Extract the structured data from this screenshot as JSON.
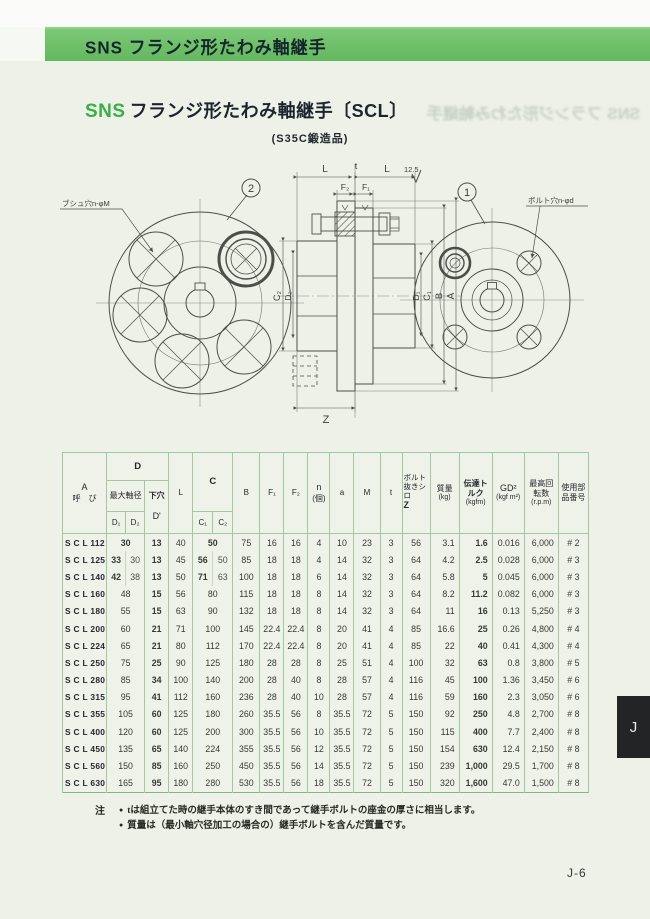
{
  "page": {
    "banner_title": "SNS フランジ形たわみ軸継手",
    "title_brand": "SNS",
    "title_text": "フランジ形たわみ軸継手〔SCL〕",
    "subtitle": "(S35C鍛造品)",
    "ghost_text": "SNS フランジ形たわみ軸継手",
    "side_tab": "J",
    "page_number": "J-6"
  },
  "drawing": {
    "balloon_left": "2",
    "balloon_right": "1",
    "callout_left": "ブシュ穴n-φM",
    "callout_right": "ボルト穴n-φd",
    "finish_mark": "12.5",
    "dims": {
      "l": "L",
      "t": "t",
      "f1": "F₁",
      "f2": "F₂",
      "c1": "C₁",
      "c2": "C₂",
      "d1": "D₁",
      "d2": "D₂",
      "b": "B",
      "a": "A",
      "z": "Z"
    }
  },
  "table": {
    "header": {
      "a_label": "A",
      "call_label": "呼　び",
      "d_group": "D",
      "max_shaft": "最大軸径",
      "pilot": "下穴",
      "pilot_sub": "D'",
      "d1": "D₁",
      "d2": "D₂",
      "l": "L",
      "c_group": "C",
      "c1": "C₁",
      "c2": "C₂",
      "b": "B",
      "f1": "F₁",
      "f2": "F₂",
      "n": "n",
      "n_unit": "(個)",
      "a": "a",
      "m": "M",
      "t": "t",
      "z_label": "ボルト抜きシロ",
      "z_sub": "Z",
      "mass": "質量",
      "mass_unit": "(kg)",
      "torque": "伝達トルク",
      "torque_unit": "(kgfm)",
      "gd2": "GD²",
      "gd2_unit": "(kgf m²)",
      "rpm": "最高回転数",
      "rpm_unit": "(r.p.m)",
      "part": "使用部品番号"
    },
    "rows": [
      {
        "name": "S C L 112",
        "d": [
          "30"
        ],
        "pilot": "13",
        "l": "40",
        "c": [
          "50"
        ],
        "b": "75",
        "f1": "16",
        "f2": "16",
        "n": "4",
        "a": "10",
        "m": "23",
        "t": "3",
        "z": "56",
        "mass": "3.1",
        "torque": "1.6",
        "gd2": "0.016",
        "rpm": "6,000",
        "part": "# 2"
      },
      {
        "name": "S C L 125",
        "d": [
          "33",
          "30"
        ],
        "pilot": "13",
        "l": "45",
        "c": [
          "56",
          "50"
        ],
        "b": "85",
        "f1": "18",
        "f2": "18",
        "n": "4",
        "a": "14",
        "m": "32",
        "t": "3",
        "z": "64",
        "mass": "4.2",
        "torque": "2.5",
        "gd2": "0.028",
        "rpm": "6,000",
        "part": "# 3"
      },
      {
        "name": "S C L 140",
        "d": [
          "42",
          "38"
        ],
        "pilot": "13",
        "l": "50",
        "c": [
          "71",
          "63"
        ],
        "b": "100",
        "f1": "18",
        "f2": "18",
        "n": "6",
        "a": "14",
        "m": "32",
        "t": "3",
        "z": "64",
        "mass": "5.8",
        "torque": "5",
        "gd2": "0.045",
        "rpm": "6,000",
        "part": "# 3"
      },
      {
        "name": "S C L 160",
        "d": [
          "48"
        ],
        "pilot": "15",
        "l": "56",
        "c": [
          "80"
        ],
        "b": "115",
        "f1": "18",
        "f2": "18",
        "n": "8",
        "a": "14",
        "m": "32",
        "t": "3",
        "z": "64",
        "mass": "8.2",
        "torque": "11.2",
        "gd2": "0.082",
        "rpm": "6,000",
        "part": "# 3"
      },
      {
        "name": "S C L 180",
        "d": [
          "55"
        ],
        "pilot": "15",
        "l": "63",
        "c": [
          "90"
        ],
        "b": "132",
        "f1": "18",
        "f2": "18",
        "n": "8",
        "a": "14",
        "m": "32",
        "t": "3",
        "z": "64",
        "mass": "11",
        "torque": "16",
        "gd2": "0.13",
        "rpm": "5,250",
        "part": "# 3"
      },
      {
        "name": "S C L 200",
        "d": [
          "60"
        ],
        "pilot": "21",
        "l": "71",
        "c": [
          "100"
        ],
        "b": "145",
        "f1": "22.4",
        "f2": "22.4",
        "n": "8",
        "a": "20",
        "m": "41",
        "t": "4",
        "z": "85",
        "mass": "16.6",
        "torque": "25",
        "gd2": "0.26",
        "rpm": "4,800",
        "part": "# 4"
      },
      {
        "name": "S C L 224",
        "d": [
          "65"
        ],
        "pilot": "21",
        "l": "80",
        "c": [
          "112"
        ],
        "b": "170",
        "f1": "22.4",
        "f2": "22.4",
        "n": "8",
        "a": "20",
        "m": "41",
        "t": "4",
        "z": "85",
        "mass": "22",
        "torque": "40",
        "gd2": "0.41",
        "rpm": "4,300",
        "part": "# 4"
      },
      {
        "name": "S C L 250",
        "d": [
          "75"
        ],
        "pilot": "25",
        "l": "90",
        "c": [
          "125"
        ],
        "b": "180",
        "f1": "28",
        "f2": "28",
        "n": "8",
        "a": "25",
        "m": "51",
        "t": "4",
        "z": "100",
        "mass": "32",
        "torque": "63",
        "gd2": "0.8",
        "rpm": "3,800",
        "part": "# 5"
      },
      {
        "name": "S C L 280",
        "d": [
          "85"
        ],
        "pilot": "34",
        "l": "100",
        "c": [
          "140"
        ],
        "b": "200",
        "f1": "28",
        "f2": "40",
        "n": "8",
        "a": "28",
        "m": "57",
        "t": "4",
        "z": "116",
        "mass": "45",
        "torque": "100",
        "gd2": "1.36",
        "rpm": "3,450",
        "part": "# 6"
      },
      {
        "name": "S C L 315",
        "d": [
          "95"
        ],
        "pilot": "41",
        "l": "112",
        "c": [
          "160"
        ],
        "b": "236",
        "f1": "28",
        "f2": "40",
        "n": "10",
        "a": "28",
        "m": "57",
        "t": "4",
        "z": "116",
        "mass": "59",
        "torque": "160",
        "gd2": "2.3",
        "rpm": "3,050",
        "part": "# 6"
      },
      {
        "name": "S C L 355",
        "d": [
          "105"
        ],
        "pilot": "60",
        "l": "125",
        "c": [
          "180"
        ],
        "b": "260",
        "f1": "35.5",
        "f2": "56",
        "n": "8",
        "a": "35.5",
        "m": "72",
        "t": "5",
        "z": "150",
        "mass": "92",
        "torque": "250",
        "gd2": "4.8",
        "rpm": "2,700",
        "part": "# 8"
      },
      {
        "name": "S C L 400",
        "d": [
          "120"
        ],
        "pilot": "60",
        "l": "125",
        "c": [
          "200"
        ],
        "b": "300",
        "f1": "35.5",
        "f2": "56",
        "n": "10",
        "a": "35.5",
        "m": "72",
        "t": "5",
        "z": "150",
        "mass": "115",
        "torque": "400",
        "gd2": "7.7",
        "rpm": "2,400",
        "part": "# 8"
      },
      {
        "name": "S C L 450",
        "d": [
          "135"
        ],
        "pilot": "65",
        "l": "140",
        "c": [
          "224"
        ],
        "b": "355",
        "f1": "35.5",
        "f2": "56",
        "n": "12",
        "a": "35.5",
        "m": "72",
        "t": "5",
        "z": "150",
        "mass": "154",
        "torque": "630",
        "gd2": "12.4",
        "rpm": "2,150",
        "part": "# 8"
      },
      {
        "name": "S C L 560",
        "d": [
          "150"
        ],
        "pilot": "85",
        "l": "160",
        "c": [
          "250"
        ],
        "b": "450",
        "f1": "35.5",
        "f2": "56",
        "n": "14",
        "a": "35.5",
        "m": "72",
        "t": "5",
        "z": "150",
        "mass": "239",
        "torque": "1,000",
        "gd2": "29.5",
        "rpm": "1,700",
        "part": "# 8"
      },
      {
        "name": "S C L 630",
        "d": [
          "165"
        ],
        "pilot": "95",
        "l": "180",
        "c": [
          "280"
        ],
        "b": "530",
        "f1": "35.5",
        "f2": "56",
        "n": "18",
        "a": "35.5",
        "m": "72",
        "t": "5",
        "z": "150",
        "mass": "320",
        "torque": "1,600",
        "gd2": "47.0",
        "rpm": "1,500",
        "part": "# 8"
      }
    ]
  },
  "notes": {
    "label": "注",
    "items": [
      "tは組立てた時の継手本体のすき間であって継手ボルトの座金の厚さに相当します。",
      "質量は（最小軸穴径加工の場合の）継手ボルトを含んだ質量です。"
    ]
  }
}
